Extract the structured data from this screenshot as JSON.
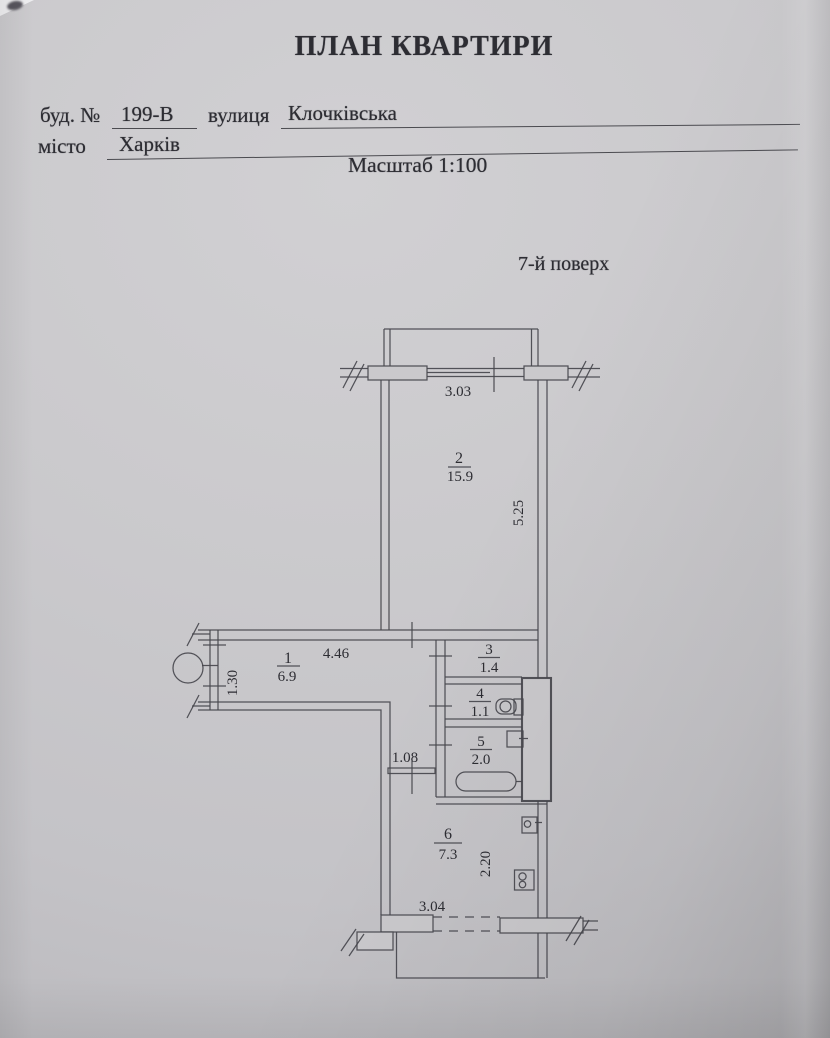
{
  "document": {
    "title": "ПЛАН КВАРТИРИ",
    "building_label": "буд. №",
    "building_number": "199-В",
    "street_label": "вулиця",
    "street_name": "Клочківська",
    "city_label": "місто",
    "city_name": "Харків",
    "scale_text": "Масштаб 1:100",
    "floor_text": "7-й поверх"
  },
  "plan": {
    "rooms": [
      {
        "number": "1",
        "area": "6.9"
      },
      {
        "number": "2",
        "area": "15.9"
      },
      {
        "number": "3",
        "area": "1.4"
      },
      {
        "number": "4",
        "area": "1.1"
      },
      {
        "number": "5",
        "area": "2.0"
      },
      {
        "number": "6",
        "area": "7.3"
      }
    ],
    "dimensions": {
      "window_top": "3.03",
      "room2_depth": "5.25",
      "hall_length": "4.46",
      "hall_width": "1.30",
      "kitchen_doorway": "1.08",
      "kitchen_depth": "2.20",
      "window_bottom": "3.04"
    },
    "fixture_icons": [
      "toilet-icon",
      "washbasin-icon",
      "bathtub-icon",
      "kitchen-sink-icon",
      "stove-icon",
      "door-knob-circle-icon",
      "vent-duct"
    ],
    "colors": {
      "paper": "#cac9cc",
      "ink": "#2d2d33",
      "line": "#47474d"
    }
  }
}
